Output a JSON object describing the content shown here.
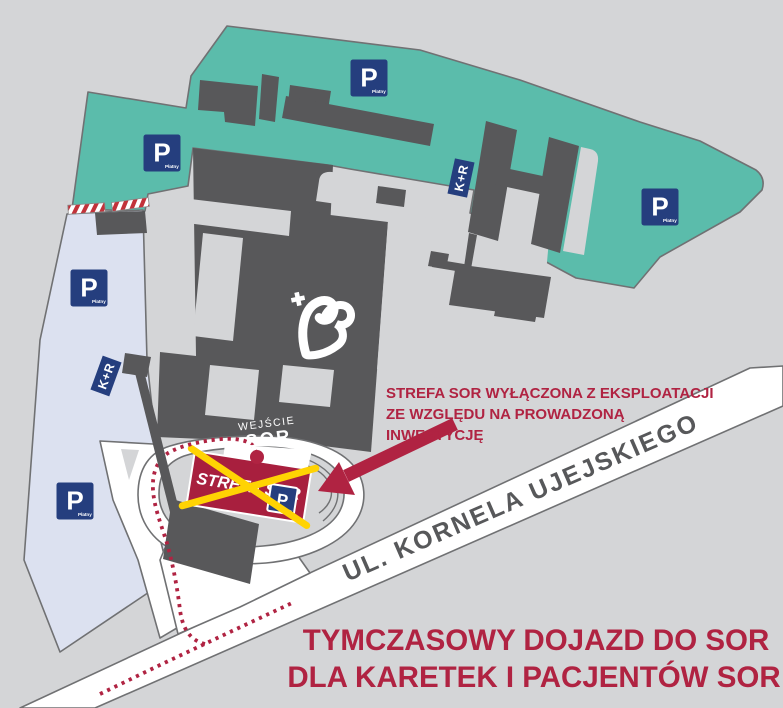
{
  "map": {
    "labels": {
      "street": "UL. KORNELA UJEJSKIEGO",
      "entrance_line1": "WEJŚCIE",
      "entrance_line2": "SOR",
      "strefa_sign": "STREFA SOR"
    },
    "signs": {
      "parking": {
        "letter": "P",
        "sublabel": "Płatny",
        "count_on_map": 5
      },
      "kiss_and_ride": {
        "label": "K+R",
        "count_on_map": 2
      }
    },
    "annotations": {
      "closure_note": {
        "line1": "STREFA SOR WYŁĄCZONA Z EKSPLOATACJI",
        "line2": "ZE WZGLĘDU NA PROWADZONĄ",
        "line3": "INWESTYCJĘ"
      },
      "footer_note": {
        "line1": "TYMCZASOWY DOJAZD DO SOR",
        "line2": "DLA KARETEK I PACJENTÓW SOR"
      }
    },
    "icons": {
      "hospital_logo": "heart-with-cross",
      "route_marker": "red-dashed-route",
      "entrance_marker": "red-dot",
      "closure_marker": "yellow-cross-over-strefa-sor"
    },
    "colors": {
      "background": "#d4d5d7",
      "paid_parking_zone_teal": "#5bbcab",
      "parking_zone_lavender": "#dce1f0",
      "building_gray": "#58585a",
      "road_white": "#ffffff",
      "sign_navy": "#253e7e",
      "alert_red": "#b02342",
      "strefa_rect_red": "#a81f3e",
      "cross_yellow": "#ffd303"
    }
  }
}
